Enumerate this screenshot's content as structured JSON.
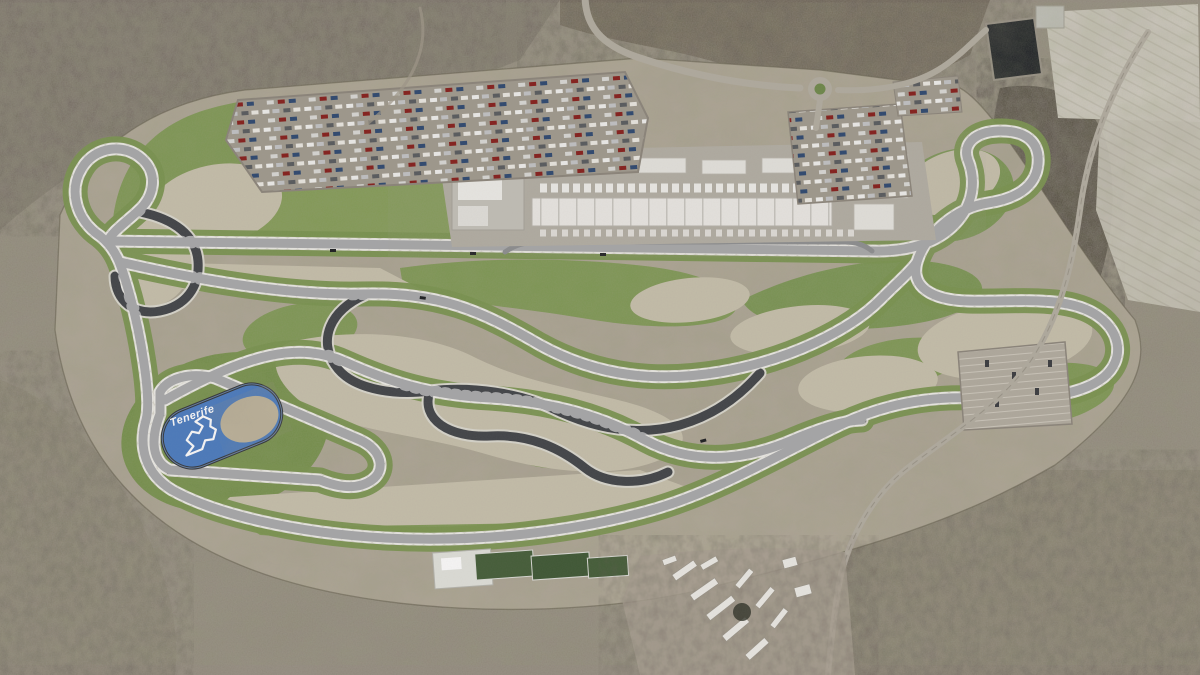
{
  "scene": {
    "title": "Aerial render of the Tenerife motor circuit",
    "description": "3D aerial rendering of a racing circuit complex built on an arid volcanic plateau, with paddock buildings, car parks, access roads, landscaped green verges, gravel run-offs and a blue lake painted with the circuit logo",
    "lake": {
      "logo_text": "Tenerife",
      "logo_icon": "circuit-outline-icon"
    }
  },
  "palette": {
    "terrain": "#948d7d",
    "terrain_dark": "#564f43",
    "plateau_scrub": "#b3ab9a",
    "gravel": "#cbc4ae",
    "grass": "#7f9b52",
    "grass_dark": "#6f8c49",
    "asphalt": "#43464a",
    "curb": "#ffffff",
    "lake_blue": "#4a7ec5",
    "building_white": "#e9e9e5",
    "road": "#b5afa2",
    "reservoir": "#171b20",
    "fields": "#d6d2c6"
  }
}
